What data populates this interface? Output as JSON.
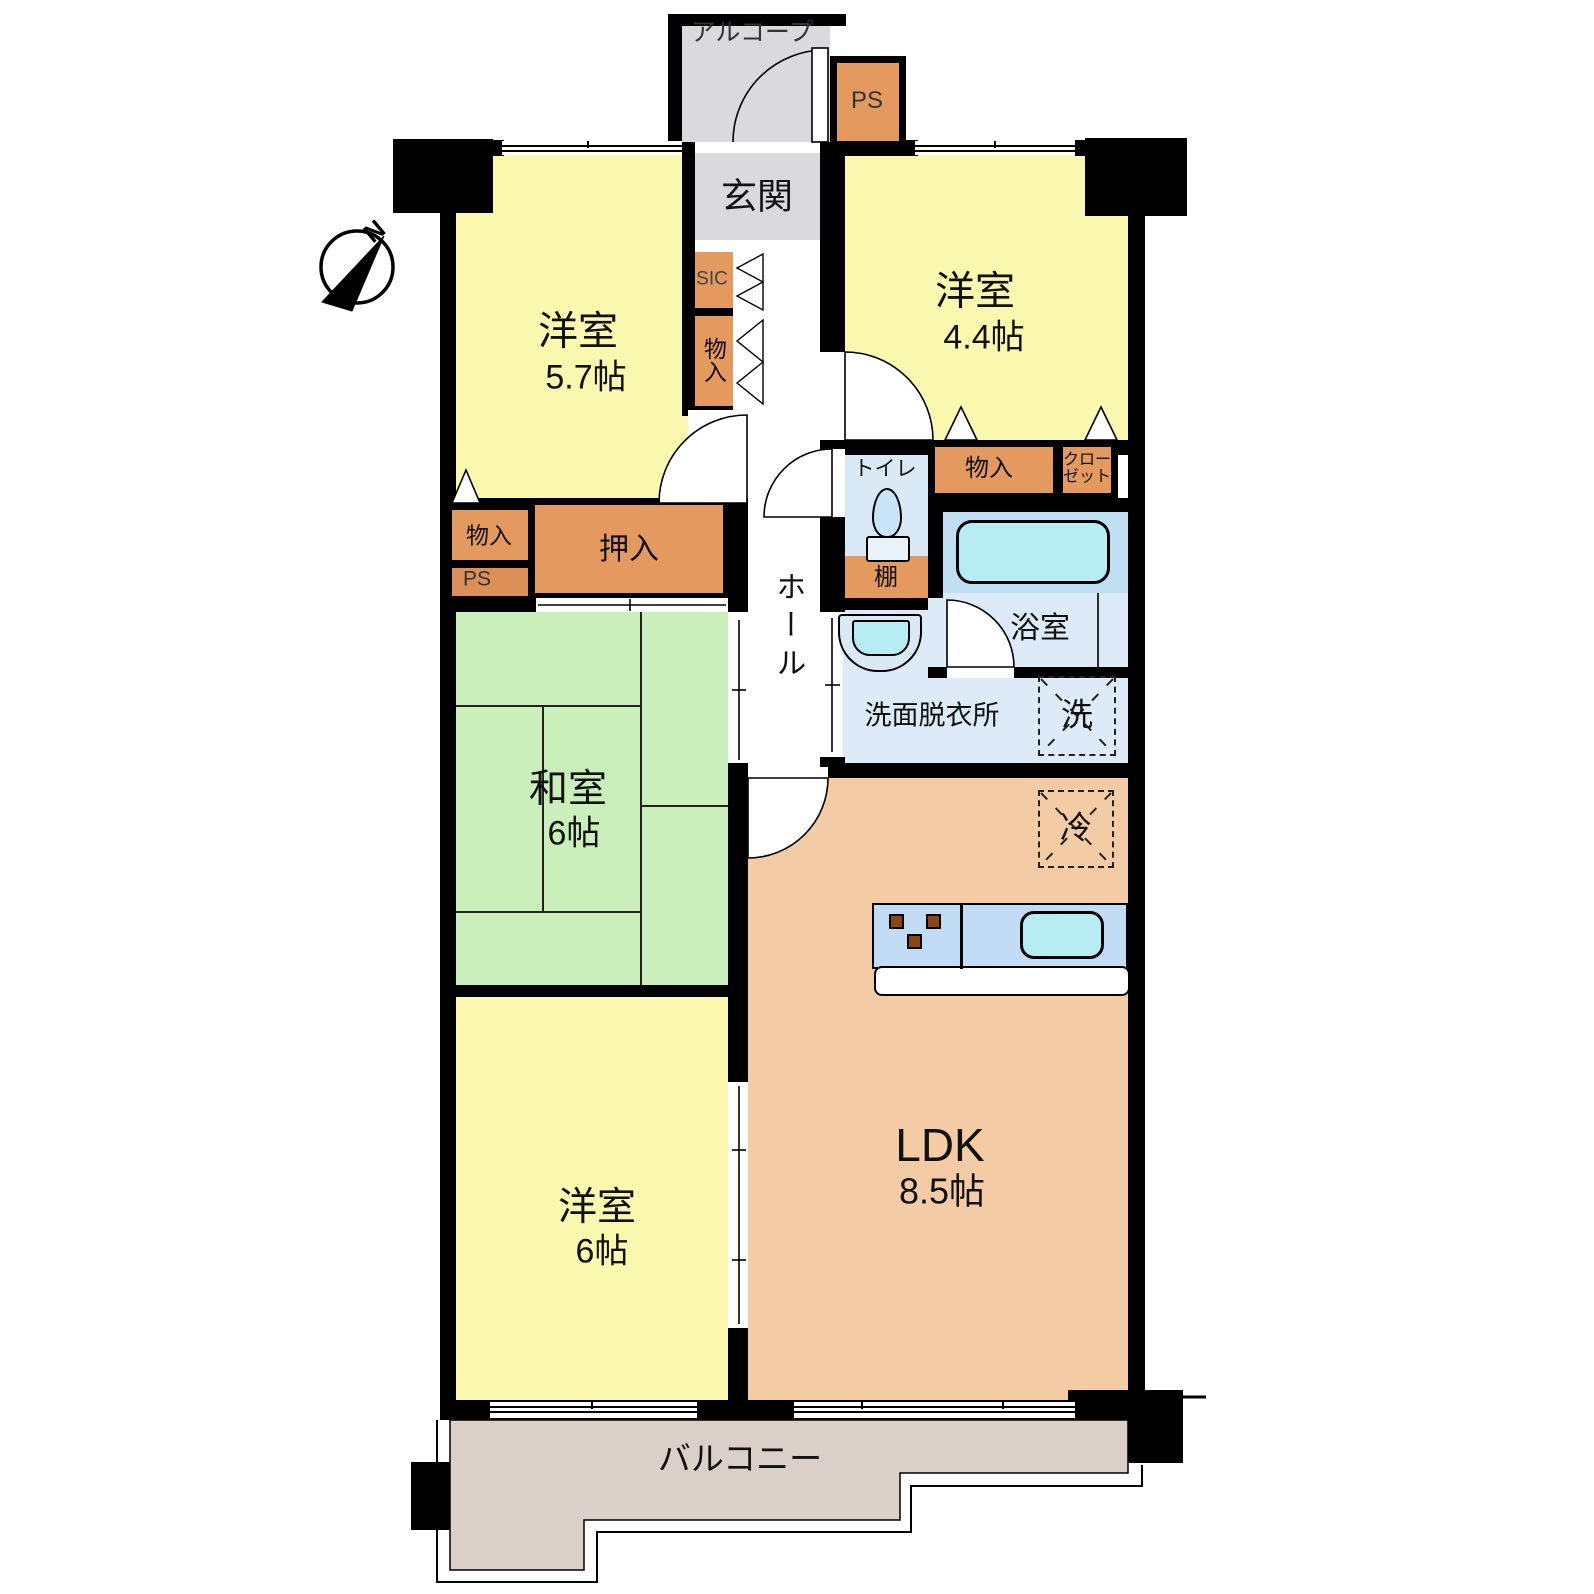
{
  "plan": {
    "compass_north": "N",
    "rooms": {
      "alcove": "アルコープ",
      "entrance": "玄関",
      "hall": "ホール",
      "west_room_57": {
        "name": "洋室",
        "size": "5.7帖"
      },
      "west_room_44": {
        "name": "洋室",
        "size": "4.4帖"
      },
      "japanese_room": {
        "name": "和室",
        "size": "6帖"
      },
      "west_room_6": {
        "name": "洋室",
        "size": "6帖"
      },
      "ldk": {
        "name": "LDK",
        "size": "8.5帖"
      },
      "toilet": "トイレ",
      "bathroom": "浴室",
      "washroom": "洗面脱衣所",
      "balcony": "バルコニー"
    },
    "storage": {
      "ps_top": "PS",
      "sic": "SIC",
      "hall_closet": "物入",
      "left_closet": "物入",
      "ps_left": "PS",
      "oshiire": "押入",
      "closet_44": "物入",
      "closet_wide": "クローゼット",
      "shelf": "棚"
    },
    "fixtures": {
      "washer": "洗",
      "fridge": "冷"
    },
    "colors": {
      "wall": "#000000",
      "west_room": "#faf7ae",
      "japanese_room": "#cbefba",
      "ldk": "#f3cba4",
      "storage": "#e49a5f",
      "storage_ps": "#dd8f58",
      "entrance_gray": "#d9d9de",
      "water_room": "#dcebf7",
      "tub_water": "#b7ecf3",
      "counter": "#c3dcf6",
      "balcony": "#dbd0c9"
    }
  }
}
